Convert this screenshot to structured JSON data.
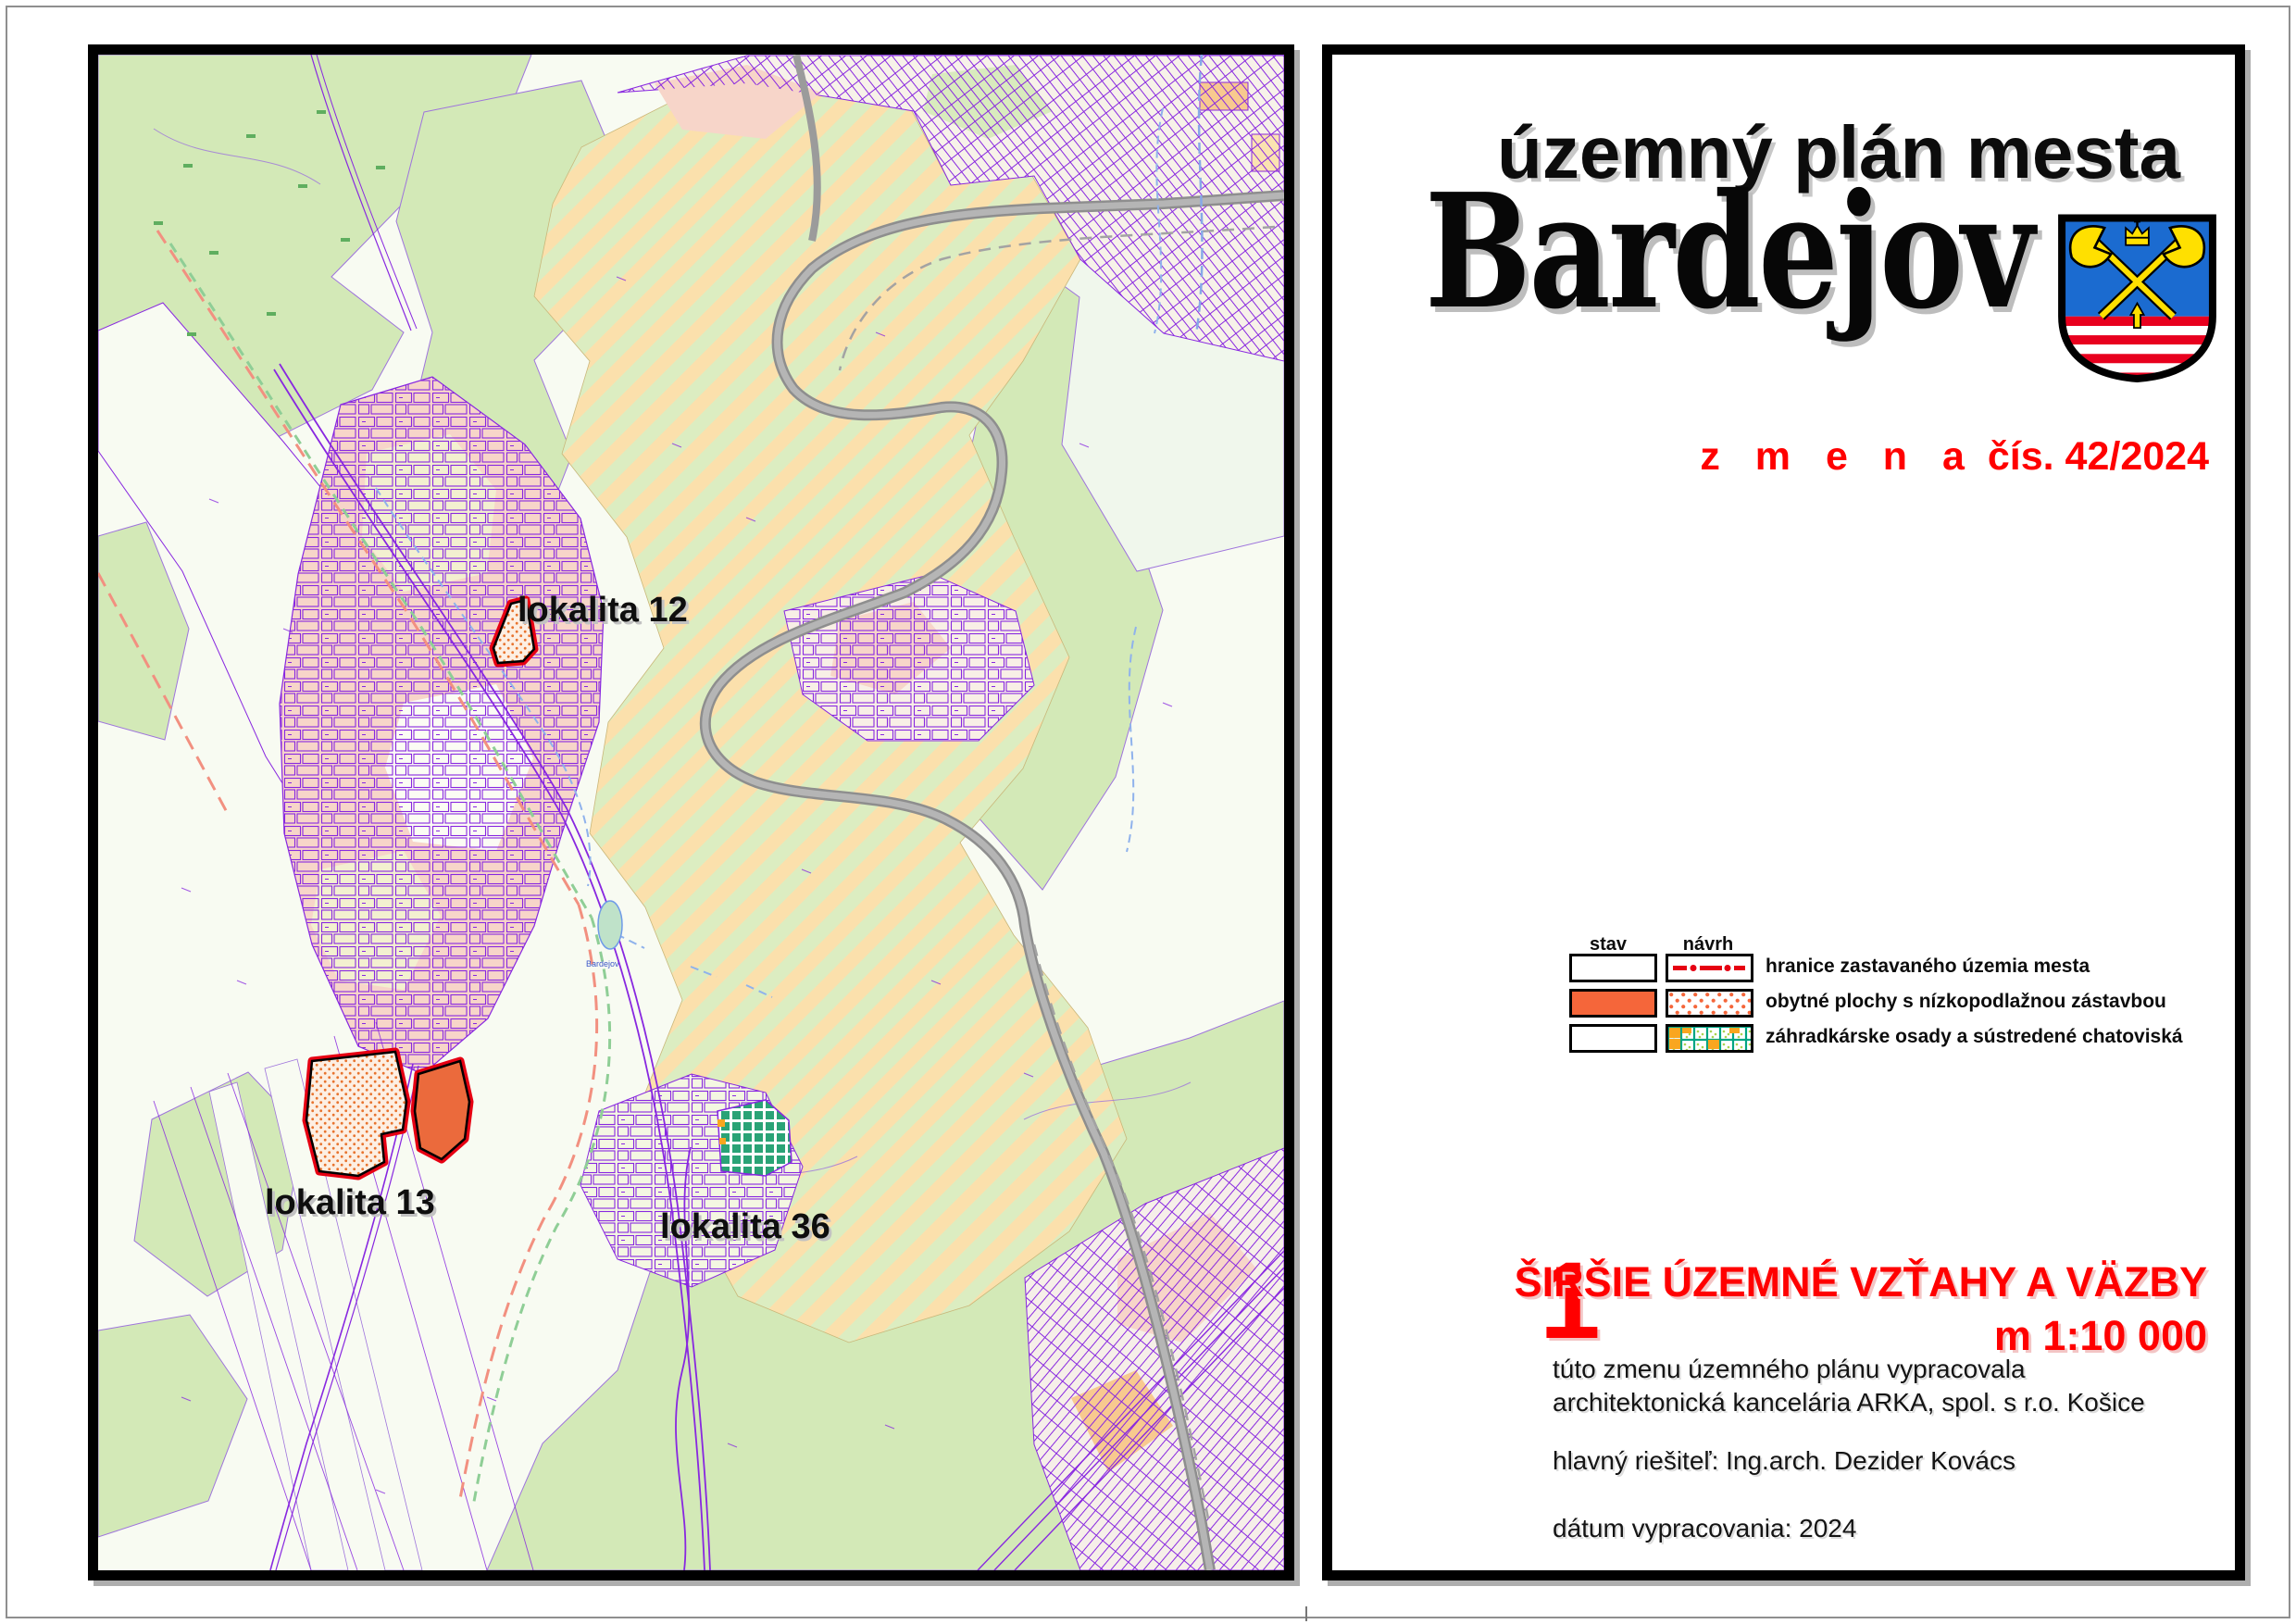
{
  "document": {
    "map": {
      "labels": {
        "lokalita12": "lokalita 12",
        "lokalita13": "lokalita 13",
        "lokalita36": "lokalita 36"
      },
      "micro_labels": {
        "pond": "Bardejov"
      }
    },
    "title": {
      "line1": "územný plán mesta",
      "line2": "Bardejov"
    },
    "change": {
      "word": "z m e n a",
      "number": "čís. 42/2024"
    },
    "legend": {
      "col_stav": "stav",
      "col_navrh": "návrh",
      "rows": [
        {
          "label": "hranice zastavaného územia mesta"
        },
        {
          "label": "obytné plochy s nízkopodlažnou zástavbou"
        },
        {
          "label": "záhradkárske osady a sústredené chatoviská"
        }
      ]
    },
    "sheet": {
      "number": "1",
      "title": "ŠIRŠIE ÚZEMNÉ VZŤAHY A VÄZBY",
      "scale": "m 1:10 000"
    },
    "credits": {
      "line1": "túto zmenu územného plánu vypracovala",
      "line2": "architektonická kancelária ARKA, spol. s r.o. Košice",
      "line3": "hlavný riešiteľ: Ing.arch. Dezider Kovács",
      "line4": "dátum vypracovania: 2024"
    },
    "colors": {
      "accent_red": "#ff0000",
      "locality_outline_red": "#e60012",
      "legend_orange": "#f5663a",
      "garden_grid_green": "#00a583",
      "garden_orange": "#f9a61f",
      "map_forest_green": "#d3e9b7",
      "map_hatch_peach": "#fbe0ac",
      "parcel_purple": "#8827e0",
      "road_gray": "#9b9b9b",
      "arms_blue": "#1b6bd0",
      "arms_yellow": "#ffe000",
      "arms_red": "#e8001e"
    }
  }
}
